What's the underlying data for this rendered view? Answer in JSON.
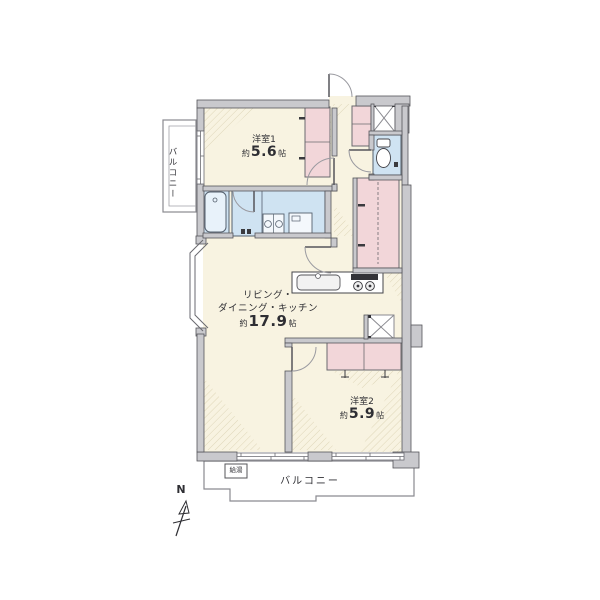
{
  "floorplan": {
    "room1": {
      "name": "洋室1",
      "size_prefix": "約",
      "size_value": "5.6",
      "size_unit": "帖"
    },
    "ldk": {
      "line1": "リビング・",
      "line2": "ダイニング・キッチン",
      "size_prefix": "約",
      "size_value": "17.9",
      "size_unit": "帖"
    },
    "room2": {
      "name": "洋室2",
      "size_prefix": "約",
      "size_value": "5.9",
      "size_unit": "帖"
    },
    "balcony_left": {
      "label": "バルコニー"
    },
    "balcony_bottom": {
      "label": "バルコニー"
    },
    "utility": {
      "label": "給湯"
    },
    "compass": {
      "label": "N"
    },
    "colors": {
      "floor": "#f8f3e1",
      "closet": "#f2d6d9",
      "wet_area": "#cfe3f2",
      "wall_fill": "#c9c9cd",
      "wall_line": "#55555a",
      "hatch": "#d8cfae",
      "text": "#2e2e33"
    }
  }
}
